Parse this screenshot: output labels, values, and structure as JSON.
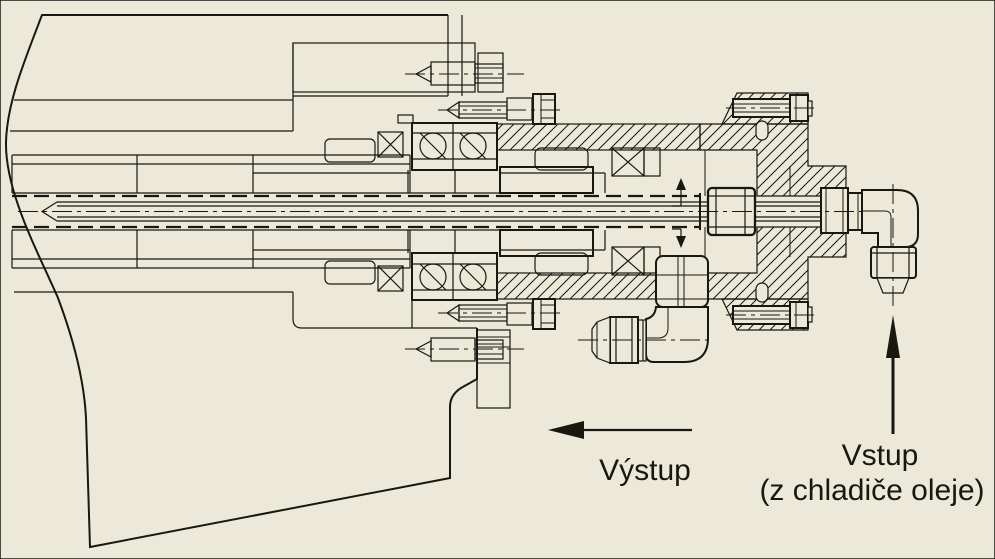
{
  "colors": {
    "background": "#ECE9D9",
    "line": "#181810"
  },
  "labels": {
    "outlet": "Výstup",
    "inlet_line1": "Vstup",
    "inlet_line2": "(z chladiče oleje)"
  },
  "arrows": {
    "outlet_direction": "left",
    "inlet_direction": "up",
    "tube_flow_direction": "left"
  }
}
